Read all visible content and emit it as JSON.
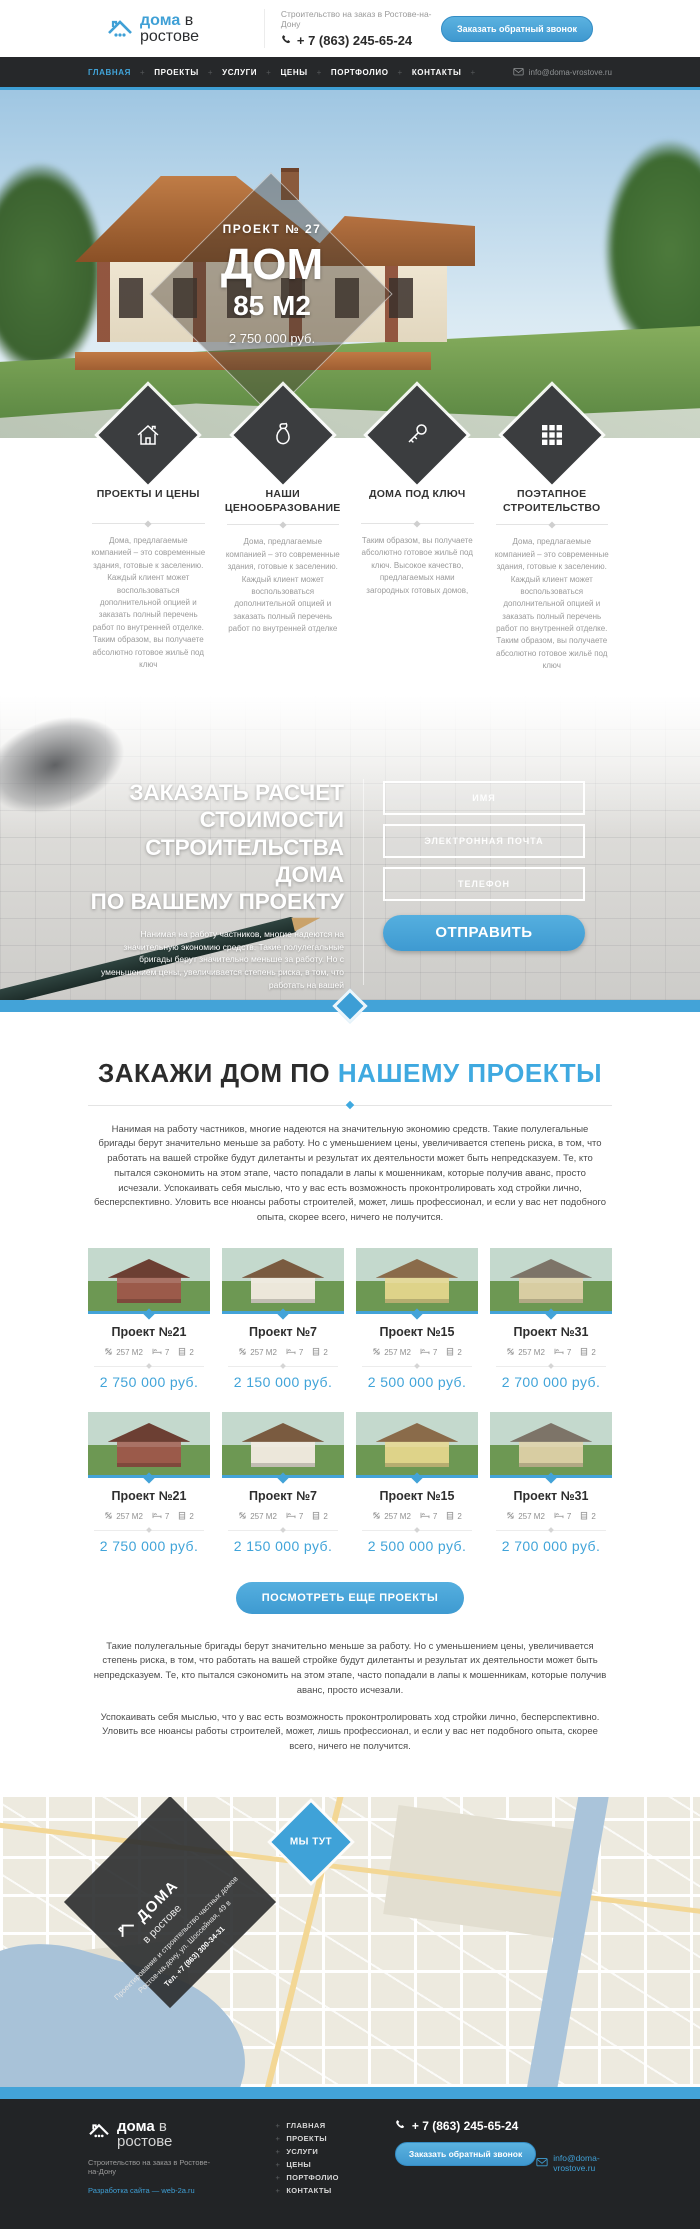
{
  "colors": {
    "accent": "#3fa0d6",
    "dark_bar": "#26282a",
    "price_blue": "#41a4d9"
  },
  "brand": {
    "logo_accent": "дома",
    "logo_rest": "в ростове",
    "tagline": "Строительство на заказ в Ростове-на-Дону",
    "phone": "+ 7 (863) 245-65-24",
    "callback_button": "Заказать обратный звонок",
    "email": "info@doma-vrostove.ru"
  },
  "nav": {
    "items": [
      {
        "label": "ГЛАВНАЯ",
        "active": true
      },
      {
        "label": "ПРОЕКТЫ",
        "active": false
      },
      {
        "label": "УСЛУГИ",
        "active": false
      },
      {
        "label": "ЦЕНЫ",
        "active": false
      },
      {
        "label": "ПОРТФОЛИО",
        "active": false
      },
      {
        "label": "КОНТАКТЫ",
        "active": false
      }
    ]
  },
  "hero": {
    "project_label": "ПРОЕКТ № 27",
    "title": "ДОМ",
    "area": "85 М2",
    "price": "2 750 000 руб."
  },
  "features": [
    {
      "icon": "house-icon",
      "title": "ПРОЕКТЫ И ЦЕНЫ",
      "text": "Дома, предлагаемые компанией – это современные здания, готовые к заселению. Каждый клиент может воспользоваться дополнительной опцией и заказать полный перечень работ по внутренней отделке. Таким образом, вы получаете абсолютно готовое жильё под ключ"
    },
    {
      "icon": "money-bag-icon",
      "title": "НАШИ ЦЕНООБРАЗОВАНИЕ",
      "text": "Дома, предлагаемые компанией – это современные здания, готовые к заселению. Каждый клиент может воспользоваться дополнительной опцией и заказать полный перечень работ по внутренней отделке"
    },
    {
      "icon": "key-icon",
      "title": "ДОМА ПОД КЛЮЧ",
      "text": "Таким образом, вы получаете абсолютно готовое жильё под ключ. Высокое качество, предлагаемых нами загородных готовых домов,"
    },
    {
      "icon": "grid-icon",
      "title": "ПОЭТАПНОЕ СТРОИТЕЛЬСТВО",
      "text": "Дома, предлагаемые компанией – это современные здания, готовые к заселению. Каждый клиент может воспользоваться дополнительной опцией и заказать полный перечень работ по внутренней отделке. Таким образом, вы получаете абсолютно готовое жильё под ключ"
    }
  ],
  "calc": {
    "heading_line1": "ЗАКАЗАТЬ РАСЧЕТ",
    "heading_line2": "СТОИМОСТИ",
    "heading_line3": "СТРОИТЕЛЬСТВА ДОМА",
    "heading_line4": "ПО ВАШЕМУ ПРОЕКТУ",
    "note": "Нанимая на работу частников, многие надеются на значительную экономию средств. Такие полулегальные бригады берут значительно меньше за работу. Но с уменьшением цены, увеличивается степень риска, в том, что работать на вашей",
    "fields": [
      {
        "placeholder": "ИМЯ"
      },
      {
        "placeholder": "ЭЛЕКТРОННАЯ ПОЧТА"
      },
      {
        "placeholder": "ТЕЛЕФОН"
      }
    ],
    "submit": "ОТПРАВИТЬ"
  },
  "projects": {
    "heading_dark": "ЗАКАЖИ ДОМ ПО",
    "heading_accent": "НАШЕМУ ПРОЕКТЫ",
    "intro": "Нанимая на работу частников, многие надеются на значительную экономию средств. Такие полулегальные бригады берут значительно меньше за работу. Но с уменьшением цены, увеличивается степень риска, в том, что работать на вашей стройке будут дилетанты и результат их деятельности может быть непредсказуем. Те, кто пытался сэкономить на этом этапе, часто попадали в лапы к мошенникам, которые получив аванс, просто исчезали. Успокаивать себя мыслью, что у вас есть возможность проконтролировать ход стройки лично, бесперспективно. Уловить все нюансы работы строителей, может, лишь профессионал, и если у вас нет подобного опыта, скорее всего, ничего не получится.",
    "cards": [
      {
        "title": "Проект №21",
        "area": "257 М2",
        "beds": "7",
        "floors": "2",
        "price": "2 750 000 руб."
      },
      {
        "title": "Проект №7",
        "area": "257 М2",
        "beds": "7",
        "floors": "2",
        "price": "2 150 000 руб."
      },
      {
        "title": "Проект №15",
        "area": "257 М2",
        "beds": "7",
        "floors": "2",
        "price": "2 500 000 руб."
      },
      {
        "title": "Проект №31",
        "area": "257 М2",
        "beds": "7",
        "floors": "2",
        "price": "2 700 000 руб."
      },
      {
        "title": "Проект №21",
        "area": "257 М2",
        "beds": "7",
        "floors": "2",
        "price": "2 750 000 руб."
      },
      {
        "title": "Проект №7",
        "area": "257 М2",
        "beds": "7",
        "floors": "2",
        "price": "2 150 000 руб."
      },
      {
        "title": "Проект №15",
        "area": "257 М2",
        "beds": "7",
        "floors": "2",
        "price": "2 500 000 руб."
      },
      {
        "title": "Проект №31",
        "area": "257 М2",
        "beds": "7",
        "floors": "2",
        "price": "2 700 000 руб."
      }
    ],
    "more_button": "ПОСМОТРЕТЬ ЕЩЕ ПРОЕКТЫ",
    "outro1": "Такие полулегальные бригады берут значительно меньше за работу. Но с уменьшением цены, увеличивается степень риска, в том, что работать на вашей стройке будут дилетанты и результат их деятельности может быть непредсказуем. Те, кто пытался сэкономить на этом этапе, часто попадали в лапы к мошенникам, которые получив аванс, просто исчезали.",
    "outro2": "Успокаивать себя мыслью, что у вас есть возможность проконтролировать ход стройки лично, бесперспективно. Уловить все нюансы работы строителей, может, лишь профессионал, и если у вас нет подобного опыта, скорее всего, ничего не получится."
  },
  "map": {
    "logo_top": "ДОМА",
    "logo_bottom": "в ростове",
    "line1": "Проектирование и строительство частных домов",
    "line2": "Ростов-на-дону, ул. Шоссейная, 49 в",
    "line3": "Тел. +7 (863) 300-34-31",
    "marker": "МЫ ТУТ"
  },
  "footer": {
    "logo_accent": "дома",
    "logo_rest": "в ростове",
    "tagline": "Строительство на заказ в Ростове-на-Дону",
    "credit": "Разработка сайта — web-2a.ru",
    "menu": [
      "ГЛАВНАЯ",
      "ПРОЕКТЫ",
      "УСЛУГИ",
      "ЦЕНЫ",
      "ПОРТФОЛИО",
      "КОНТАКТЫ"
    ],
    "phone": "+ 7 (863) 245-65-24",
    "callback_button": "Заказать обратный звонок",
    "email": "info@doma-vrostove.ru"
  }
}
